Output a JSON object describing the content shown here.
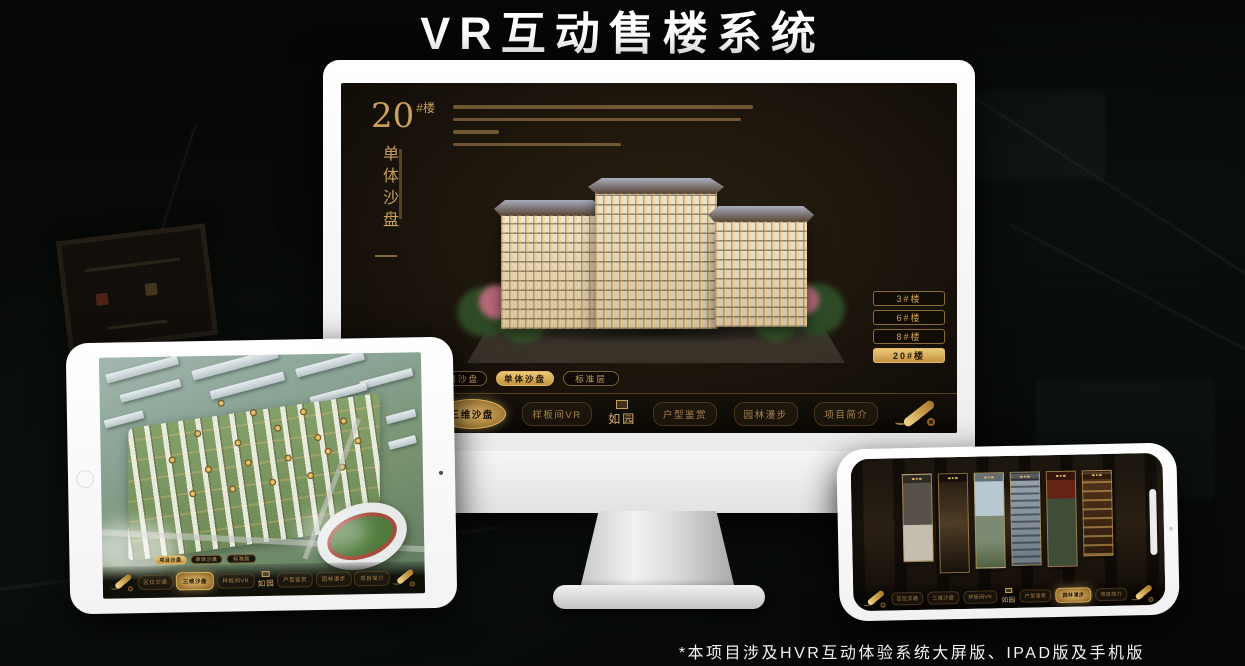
{
  "page": {
    "title": "VR互动售楼系统",
    "footnote": "*本项目涉及HVR互动体验系统大屏版、IPAD版及手机版"
  },
  "colors": {
    "gold": "#c9a05a",
    "gold_bright": "#ecc878",
    "page_bg": "#070a08",
    "device_white": "#f7f7f7",
    "screen_bg": "#1c150c"
  },
  "app": {
    "logo": "如园",
    "block": {
      "number": "20",
      "suffix": "#楼",
      "subtitle": "单体沙盘"
    },
    "floor_buttons": [
      "3#楼",
      "6#楼",
      "8#楼",
      "20#楼"
    ],
    "active_floor": "20#楼",
    "view_tabs": [
      "项目沙盘",
      "单体沙盘",
      "标准层"
    ],
    "monitor_active_tab": "单体沙盘",
    "tablet_active_tab": "项目沙盘",
    "nav_items": [
      "区位交通",
      "三维沙盘",
      "样板间VR",
      "户型鉴赏",
      "园林漫步",
      "项目简介"
    ],
    "active_nav": "三维沙盘"
  }
}
